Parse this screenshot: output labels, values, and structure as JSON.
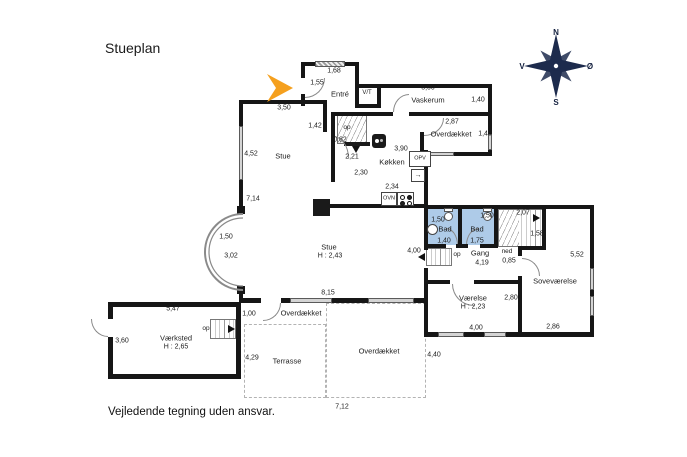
{
  "title": "Stueplan",
  "disclaimer": "Vejledende tegning uden ansvar.",
  "compass": {
    "n": "N",
    "s": "S",
    "e": "Ø",
    "w": "V"
  },
  "colors": {
    "wall": "#161616",
    "bathroom": "#aecbe8",
    "arrow": "#f5a01e",
    "compass": "#1d2b4d",
    "window": "#d4d4d4",
    "dashed_outline": "#b3b3b3"
  },
  "rooms": [
    "Entré",
    "Vaskerum",
    "Køkken",
    "Stue",
    "Bad",
    "Bad",
    "Gang",
    "Soveværelse",
    "Værelse",
    "Værksted",
    "Terrasse",
    "Overdækket",
    "Overdækket",
    "Overdækket"
  ],
  "plan": {
    "labels": [
      {
        "t": "3,50",
        "x": 284,
        "y": 108,
        "n": "dim"
      },
      {
        "t": "1,68",
        "x": 334,
        "y": 71,
        "n": "dim"
      },
      {
        "t": "1,55",
        "x": 317,
        "y": 83,
        "n": "dim"
      },
      {
        "t": "Entré",
        "x": 340,
        "y": 94,
        "n": "room-entre"
      },
      {
        "t": "V/T",
        "x": 367,
        "y": 93,
        "n": "room-vt",
        "s": 6
      },
      {
        "t": "5,00",
        "x": 428,
        "y": 88,
        "n": "dim"
      },
      {
        "t": "Vaskerum",
        "x": 428,
        "y": 100,
        "n": "room-vaskerum"
      },
      {
        "t": "1,40",
        "x": 478,
        "y": 100,
        "n": "dim"
      },
      {
        "t": "2,87",
        "x": 452,
        "y": 122,
        "n": "dim"
      },
      {
        "t": "Overdækket",
        "x": 451,
        "y": 134,
        "n": "room-overdaekket-ne"
      },
      {
        "t": "1,48",
        "x": 485,
        "y": 134,
        "n": "dim"
      },
      {
        "t": "1,42",
        "x": 315,
        "y": 126,
        "n": "dim"
      },
      {
        "t": "op",
        "x": 347,
        "y": 128,
        "n": "stair-label",
        "s": 6.5
      },
      {
        "t": "0,82",
        "x": 340,
        "y": 140,
        "n": "dim"
      },
      {
        "t": "2,21",
        "x": 352,
        "y": 157,
        "n": "dim"
      },
      {
        "t": "2,30",
        "x": 361,
        "y": 173,
        "n": "dim"
      },
      {
        "t": "Køkken",
        "x": 392,
        "y": 162,
        "n": "room-koekken"
      },
      {
        "t": "3,90",
        "x": 401,
        "y": 149,
        "n": "dim"
      },
      {
        "t": "OPV",
        "x": 420,
        "y": 159,
        "n": "fixture-opv-label",
        "s": 5.5
      },
      {
        "t": "2,34",
        "x": 392,
        "y": 187,
        "n": "dim"
      },
      {
        "t": "OVN",
        "x": 389,
        "y": 199,
        "n": "fixture-ovn-label",
        "s": 5.5
      },
      {
        "t": "4,52",
        "x": 251,
        "y": 154,
        "n": "dim"
      },
      {
        "t": "Stue",
        "x": 283,
        "y": 156,
        "n": "room-stue"
      },
      {
        "t": "7,14",
        "x": 253,
        "y": 199,
        "n": "dim"
      },
      {
        "t": "1,50",
        "x": 226,
        "y": 237,
        "n": "dim"
      },
      {
        "t": "3,02",
        "x": 231,
        "y": 256,
        "n": "dim"
      },
      {
        "t": "Stue",
        "x": 329,
        "y": 247,
        "n": "room-stue-main"
      },
      {
        "t": "H : 2,43",
        "x": 330,
        "y": 256,
        "n": "dim"
      },
      {
        "t": "4,00",
        "x": 414,
        "y": 251,
        "n": "dim"
      },
      {
        "t": "1,50",
        "x": 438,
        "y": 220,
        "n": "dim"
      },
      {
        "t": "Bad",
        "x": 445,
        "y": 229,
        "n": "room-bad-1"
      },
      {
        "t": "1,40",
        "x": 444,
        "y": 241,
        "n": "dim"
      },
      {
        "t": "1,50",
        "x": 487,
        "y": 216,
        "n": "dim"
      },
      {
        "t": "Bad",
        "x": 477,
        "y": 229,
        "n": "room-bad-2"
      },
      {
        "t": "1,75",
        "x": 477,
        "y": 241,
        "n": "dim"
      },
      {
        "t": "2,07",
        "x": 523,
        "y": 213,
        "n": "dim"
      },
      {
        "t": "1,58",
        "x": 537,
        "y": 234,
        "n": "dim"
      },
      {
        "t": "op",
        "x": 457,
        "y": 255,
        "n": "stair-label",
        "s": 6.5
      },
      {
        "t": "Gang",
        "x": 480,
        "y": 253,
        "n": "room-gang"
      },
      {
        "t": "4,19",
        "x": 482,
        "y": 263,
        "n": "dim"
      },
      {
        "t": "ned",
        "x": 507,
        "y": 252,
        "n": "stair-label",
        "s": 6.5
      },
      {
        "t": "0,85",
        "x": 509,
        "y": 261,
        "n": "dim"
      },
      {
        "t": "Soveværelse",
        "x": 555,
        "y": 281,
        "n": "room-sovevaerelse"
      },
      {
        "t": "5,52",
        "x": 577,
        "y": 255,
        "n": "dim"
      },
      {
        "t": "2,80",
        "x": 511,
        "y": 298,
        "n": "dim"
      },
      {
        "t": "Værelse",
        "x": 473,
        "y": 298,
        "n": "room-vaerelse"
      },
      {
        "t": "H : 2,23",
        "x": 473,
        "y": 307,
        "n": "dim"
      },
      {
        "t": "4,00",
        "x": 476,
        "y": 328,
        "n": "dim"
      },
      {
        "t": "2,86",
        "x": 553,
        "y": 327,
        "n": "dim"
      },
      {
        "t": "8,15",
        "x": 328,
        "y": 293,
        "n": "dim"
      },
      {
        "t": "Overdækket",
        "x": 301,
        "y": 313,
        "n": "room-overdaekket-small"
      },
      {
        "t": "1,00",
        "x": 249,
        "y": 314,
        "n": "dim"
      },
      {
        "t": "5,47",
        "x": 173,
        "y": 309,
        "n": "dim"
      },
      {
        "t": "3,60",
        "x": 122,
        "y": 341,
        "n": "dim"
      },
      {
        "t": "Værksted",
        "x": 176,
        "y": 338,
        "n": "room-vaerksted"
      },
      {
        "t": "H : 2,65",
        "x": 176,
        "y": 347,
        "n": "dim"
      },
      {
        "t": "op",
        "x": 206,
        "y": 329,
        "n": "stair-label",
        "s": 6.5
      },
      {
        "t": "4,29",
        "x": 252,
        "y": 358,
        "n": "dim"
      },
      {
        "t": "Terrasse",
        "x": 287,
        "y": 361,
        "n": "room-terrasse"
      },
      {
        "t": "Overdækket",
        "x": 379,
        "y": 351,
        "n": "room-overdaekket-s"
      },
      {
        "t": "4,40",
        "x": 434,
        "y": 355,
        "n": "dim"
      },
      {
        "t": "7,12",
        "x": 342,
        "y": 407,
        "n": "dim"
      }
    ]
  }
}
